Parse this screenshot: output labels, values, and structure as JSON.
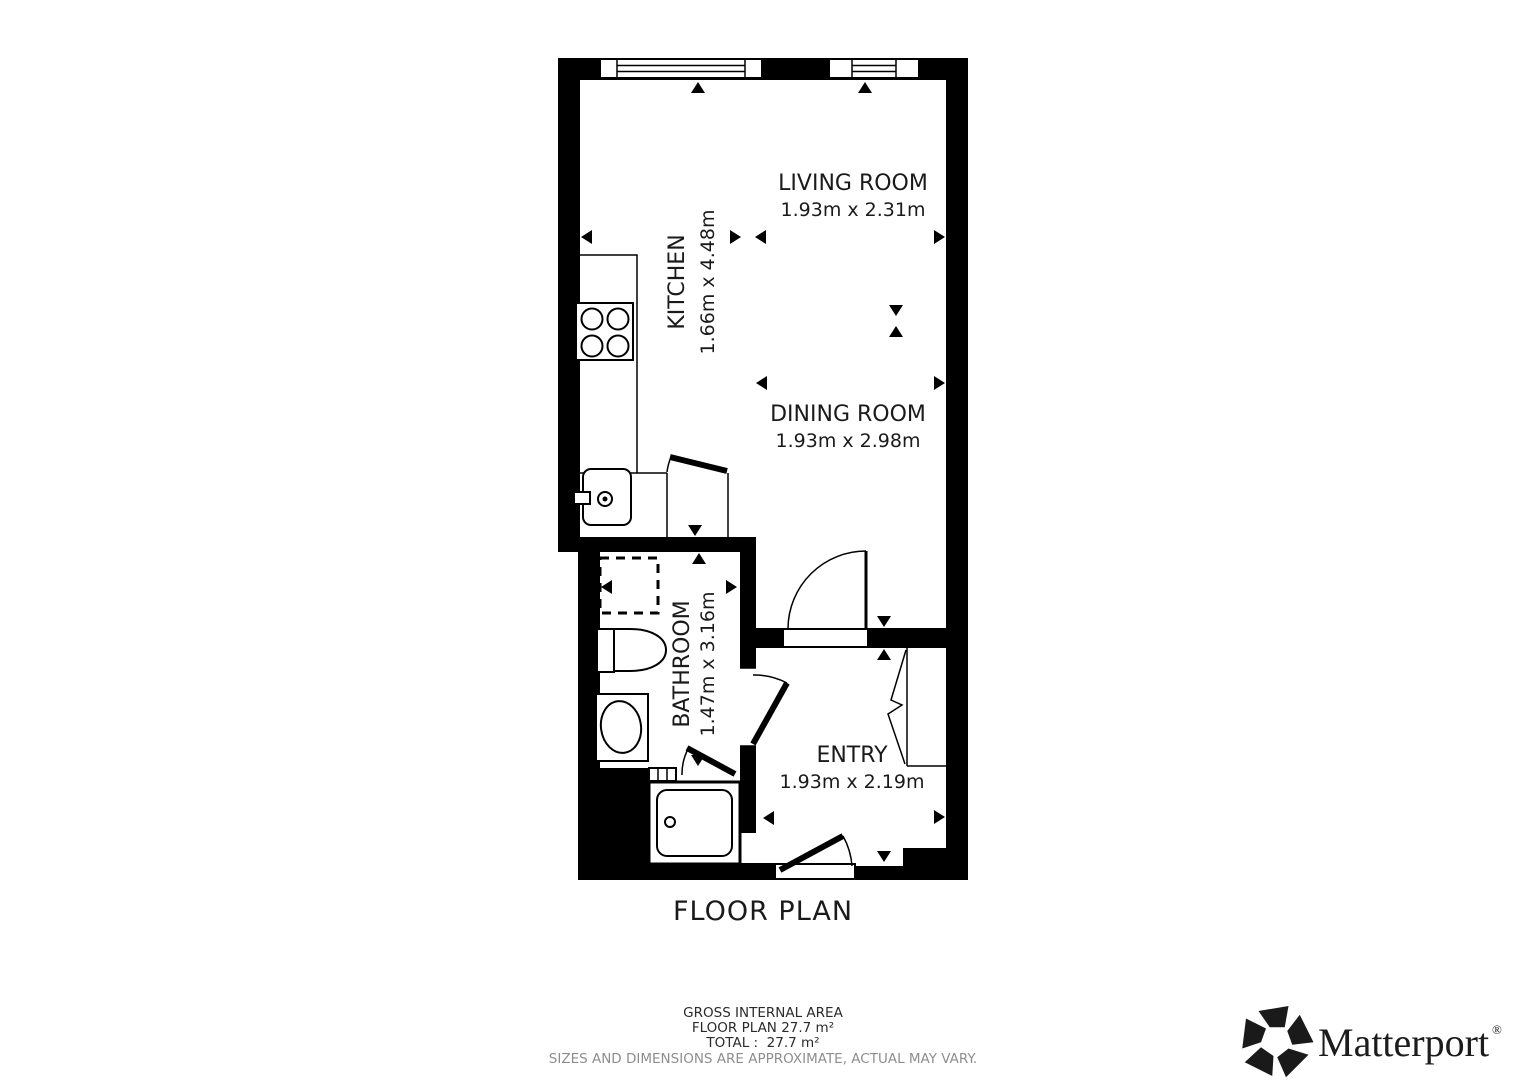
{
  "plan": {
    "title": "FLOOR PLAN",
    "rooms": [
      {
        "name": "LIVING ROOM",
        "dims": "1.93m x 2.31m"
      },
      {
        "name": "KITCHEN",
        "dims": "1.66m x 4.48m"
      },
      {
        "name": "DINING ROOM",
        "dims": "1.93m x 2.98m"
      },
      {
        "name": "BATHROOM",
        "dims": "1.47m x 3.16m"
      },
      {
        "name": "ENTRY",
        "dims": "1.93m x 2.19m"
      }
    ]
  },
  "footer": {
    "line1": "GROSS INTERNAL AREA",
    "line2": "FLOOR PLAN 27.7 m²",
    "line3": "TOTAL :  27.7 m²",
    "disclaimer": "SIZES AND DIMENSIONS ARE APPROXIMATE, ACTUAL MAY VARY."
  },
  "branding": {
    "logo_text": "Matterport",
    "registered": "®"
  },
  "colors": {
    "wall": "#000000",
    "background": "#ffffff",
    "text": "#1a1a1a",
    "disclaimer_text": "#8e8e8e",
    "logo": "#1a1a1a"
  }
}
